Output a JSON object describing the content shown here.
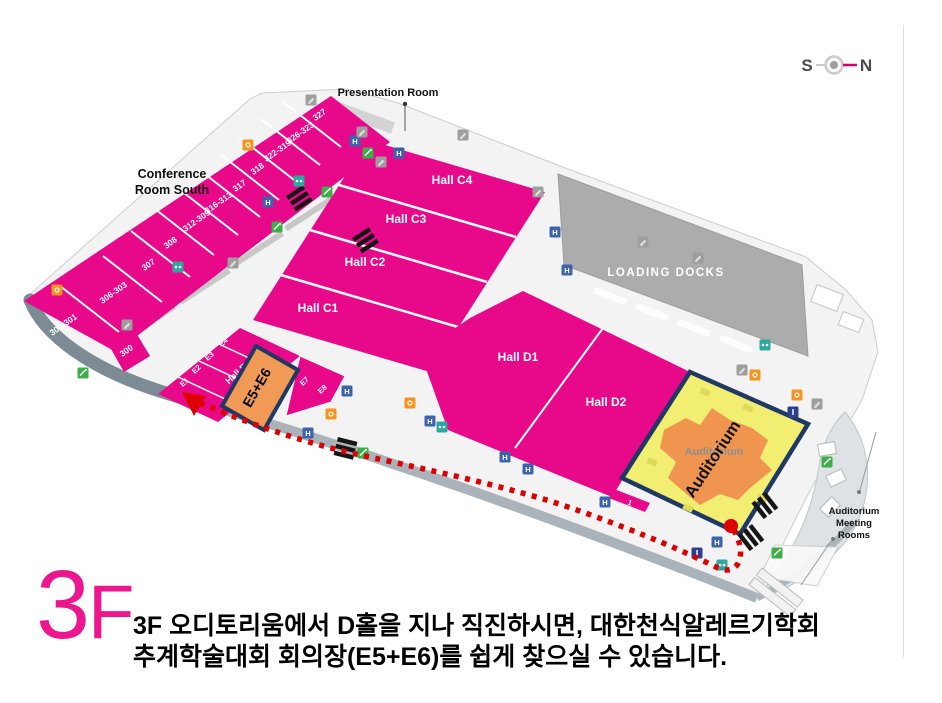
{
  "floor_label_digit": "3",
  "floor_label_letter": "F",
  "compass": {
    "south": "S",
    "north": "N"
  },
  "map": {
    "presentation_room": "Presentation Room",
    "conference_room_south_line1": "Conference",
    "conference_room_south_line2": "Room South",
    "loading_docks": "LOADING DOCKS",
    "auditorium_label": "Auditorium",
    "auditorium_highlight": "Auditorium",
    "meeting_rooms_line1": "Auditorium",
    "meeting_rooms_line2": "Meeting",
    "meeting_rooms_line3": "Rooms",
    "highlight_box": "E5+E6",
    "halls": {
      "c1": "Hall C1",
      "c2": "Hall C2",
      "c3": "Hall C3",
      "c4": "Hall C4",
      "d1": "Hall D1",
      "d2": "Hall D2",
      "e": "Hall E"
    },
    "e_rooms": {
      "e1": "E1",
      "e2": "E2",
      "e3": "E3",
      "e4": "E4",
      "e7": "E7",
      "e8": "E8"
    },
    "small_room_1": "1",
    "small_room_2": "2",
    "conference_rooms": {
      "r327": "327",
      "r323": "326-323",
      "r319": "322-319",
      "r318": "318",
      "r317": "317",
      "r313": "316-313",
      "r309": "312-309",
      "r308": "308",
      "r307": "307",
      "r303": "306-303",
      "r301": "302-301",
      "r300": "300"
    }
  },
  "icons": {
    "elevator_glyph": "H"
  },
  "caption": {
    "line1": "3F 오디토리움에서 D홀을 지나 직진하시면, 대한천식알레르기학회",
    "line2": "추계학술대회 회의장(E5+E6)를 쉽게 찾으실 수 있습니다."
  },
  "colors": {
    "hall_magenta": "#E8088A",
    "highlight_orange": "#F09A55",
    "auditorium_yellow": "#F1EE71",
    "auditorium_orange": "#EF954F",
    "navy_border": "#1F3864",
    "route_red": "#DE0000",
    "dock_gray": "#ACACAC",
    "floor_label_pink": "#EC168F"
  }
}
